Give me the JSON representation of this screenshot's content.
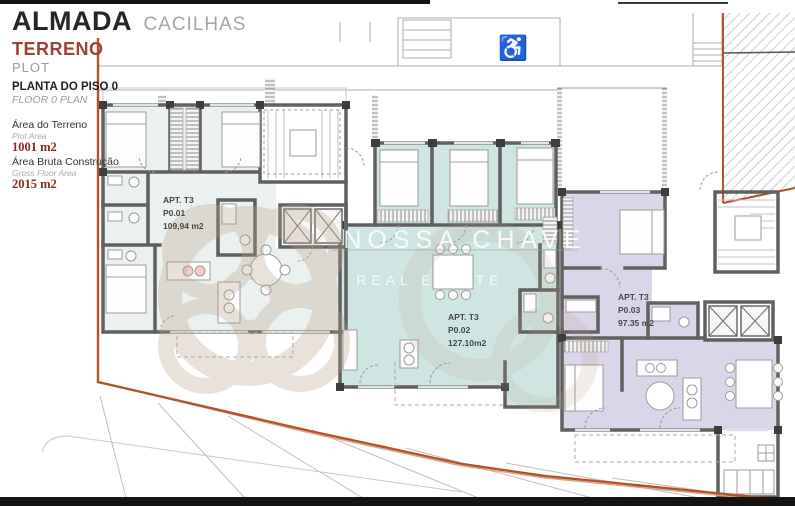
{
  "panel": {
    "title": "ALMADA",
    "subtitle": "CACILHAS",
    "section_pt": "TERRENO",
    "section_en": "PLOT",
    "plan_pt": "PLANTA DO PISO 0",
    "plan_en": "FLOOR 0 PLAN",
    "plot_label_pt": "Área do Terreno",
    "plot_label_en": "Plot Area",
    "plot_value": "1001 m2",
    "gross_label_pt": "Área Bruta Construção",
    "gross_label_en": "Gross Floor Area",
    "gross_value": "2015 m2"
  },
  "apartments": [
    {
      "name": "APT. T3",
      "unit": "P0.01",
      "area": "109,94 m2"
    },
    {
      "name": "APT. T3",
      "unit": "P0.02",
      "area": "127.10m2"
    },
    {
      "name": "APT. T3",
      "unit": "P0.03",
      "area": "97.35 m2"
    }
  ],
  "watermark": {
    "line1": "NOSSA CHAVE",
    "line2": "REAL ESTATE"
  },
  "icons": {
    "accessible": "♿"
  },
  "colors": {
    "apartment1_fill": "#eaf1ee",
    "apartment2_fill": "#cfe5e1",
    "apartment3_fill": "#dad5e8",
    "boundary": "#b2532c",
    "wall": "#606060",
    "accent_red_text": "#8c2b22"
  }
}
